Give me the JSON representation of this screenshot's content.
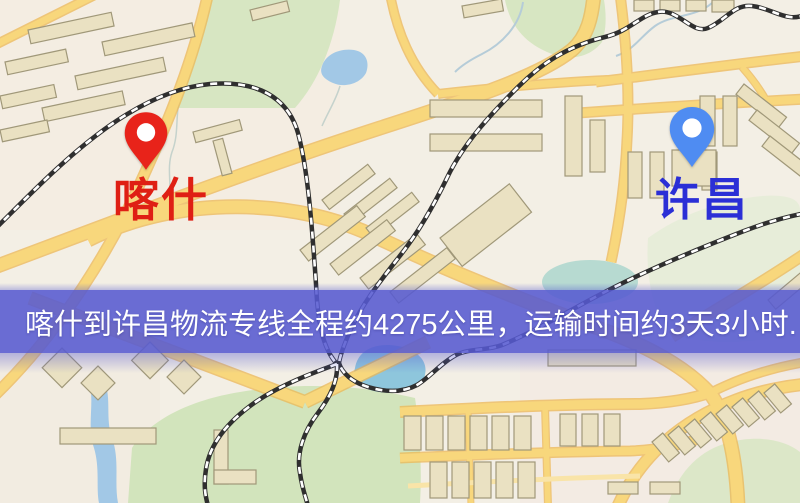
{
  "map": {
    "markers": [
      {
        "id": "kashi",
        "label": "喀什",
        "color": "#df1f14",
        "pin_color": "#e8231a",
        "icon": "red-location-pin-icon"
      },
      {
        "id": "xuchang",
        "label": "许昌",
        "color": "#2b2fd6",
        "pin_color": "#4f8cf2",
        "icon": "blue-location-pin-icon"
      }
    ],
    "banner": {
      "text": "喀什到许昌物流专线全程约4275公里，运输时间约3天3小时.",
      "background_rgba": "rgba(86,90,208,0.88)",
      "text_color": "#ffffff"
    },
    "route": {
      "origin": "喀什",
      "destination": "许昌",
      "distance_km": "4275",
      "duration": "3天3小时"
    },
    "colors": {
      "background": "#f2eee3",
      "road_fill": "#f8d77c",
      "road_casing": "#edb855",
      "park_green": "#d2e4bc",
      "water_blue": "#a2c8e6",
      "railway_dark": "#2f2f2f",
      "building_fill": "#eae1c2"
    }
  }
}
